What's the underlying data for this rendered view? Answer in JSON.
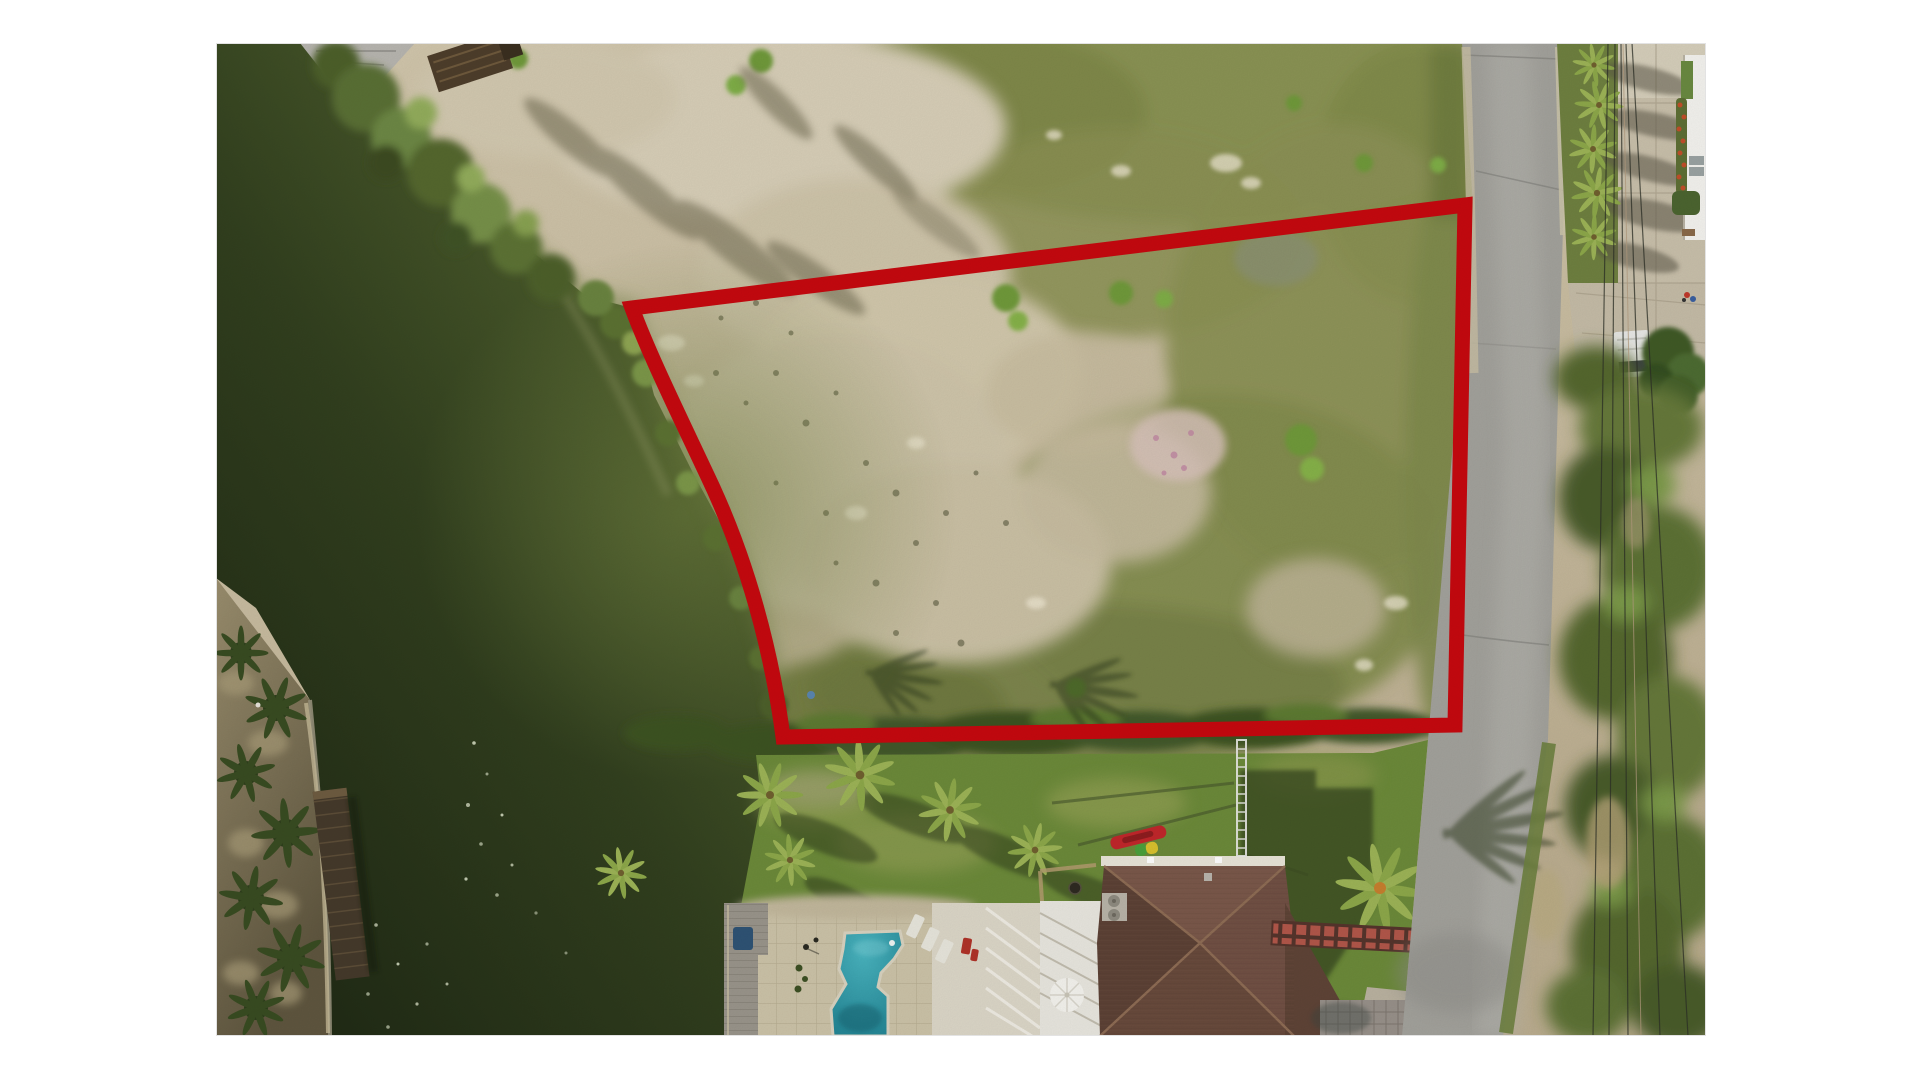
{
  "page": {
    "background": "#ffffff",
    "content": "aerial-drone-photograph"
  },
  "photo": {
    "x": 216,
    "y": 43,
    "width": 1490,
    "height": 993,
    "subject": "canal-front vacant land parcel outlined in red, bordered by a street on the east and a house with pool to the south"
  },
  "boundary": {
    "path": "M 416 265 L 1249 162 L 1239 682 L 567 694 C 556 610 532 518 492 434 C 461 368 433 311 416 265 Z",
    "color": "#c6090f",
    "stroke_width": 15,
    "vertices": [
      [
        416,
        265
      ],
      [
        1249,
        162
      ],
      [
        1239,
        682
      ],
      [
        567,
        694
      ]
    ]
  },
  "features": [
    {
      "id": "canal-water",
      "label": "dark green canal water"
    },
    {
      "id": "vacant-lot",
      "label": "cleared sand and scrub homesite"
    },
    {
      "id": "parcel-boundary",
      "label": "red property outline"
    },
    {
      "id": "street",
      "label": "asphalt street running north-south"
    },
    {
      "id": "power-lines",
      "label": "overhead utility lines east of street"
    },
    {
      "id": "palm-row",
      "label": "row of palms on east verge"
    },
    {
      "id": "white-building",
      "label": "white building at far east edge"
    },
    {
      "id": "pickup-truck",
      "label": "white pickup on east driveway"
    },
    {
      "id": "house-roof",
      "label": "brown hip roof house"
    },
    {
      "id": "swimming-pool",
      "label": "turquoise pool with paver deck"
    },
    {
      "id": "boardwalk",
      "label": "grey dock boardwalk on seawall"
    },
    {
      "id": "wooden-pier",
      "label": "dark wooden pier on west shore"
    },
    {
      "id": "kayak",
      "label": "red kayak on deck"
    },
    {
      "id": "red-walkway",
      "label": "red tile walkway to street"
    }
  ],
  "colors": {
    "sand": "#c9bda1",
    "sand_bright": "#d9d1ba",
    "water_dark": "#1d2613",
    "water_mid": "#32401f",
    "water_light": "#556631",
    "glint": "#6d7d3e",
    "scrub": "#8b9154",
    "lawn": "#6c8a3a",
    "hedge": "#3c5222",
    "road": "#a3a29c",
    "shoulder": "#c8bfa4",
    "concrete": "#c9c0ab",
    "building_white": "#f4f3ef",
    "roof_top": "#7a584a",
    "roof_left": "#5d4236",
    "roof_right": "#715044",
    "roof_bottom": "#684a3c",
    "fascia": "#e9e5d8",
    "pool_light": "#4ab5c0",
    "pool_deep": "#1e7e8e",
    "pool_deck": "#ccc3a8",
    "white_deck": "#dcd7c8",
    "boardwalk": "#9a958b",
    "pier": "#453a2b",
    "beach": "#8a7f63",
    "kayak_red": "#c1272b",
    "walkway_tile": "#b2574a",
    "boundary_red": "#c6090f",
    "power_line": "#2c2f26",
    "palm": "#8da84a"
  }
}
